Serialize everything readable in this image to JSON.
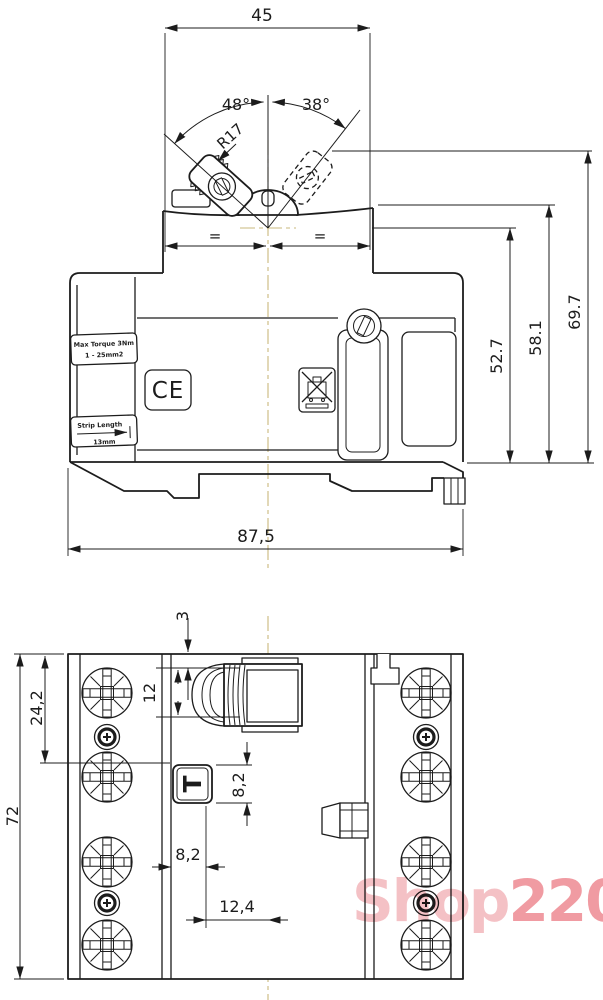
{
  "side_view": {
    "dim_top_width": "45",
    "dim_angle_left": "48°",
    "dim_angle_right": "38°",
    "dim_lever_radius": "R17",
    "equal_left": "=",
    "equal_right": "=",
    "dim_height_body": "52.7",
    "dim_height_mid": "58.1",
    "dim_height_total": "69.7",
    "dim_total_width": "87,5",
    "label_torque_line1": "Max Torque 3Nm",
    "label_torque_line2": "1 - 25mm2",
    "label_ce_mark": "CE",
    "label_strip_line1": "Strip Length",
    "label_strip_line2": "13mm"
  },
  "front_view": {
    "dim_handle_protrusion": "3",
    "dim_handle_width": "12",
    "dim_pole_offset": "24,2",
    "dim_total_height": "72",
    "dim_test_button_height": "8,2",
    "dim_test_button_offset": "8,2",
    "dim_center_offset": "12,4",
    "test_button_label": "T"
  },
  "watermark": {
    "text_light": "Shop",
    "text_dark": "220",
    "color_light": "#f3b6bb",
    "color_dark": "#ee8a92"
  },
  "colors": {
    "line": "#1c1c1c",
    "centerline": "#c9b97c",
    "background": "#ffffff"
  }
}
